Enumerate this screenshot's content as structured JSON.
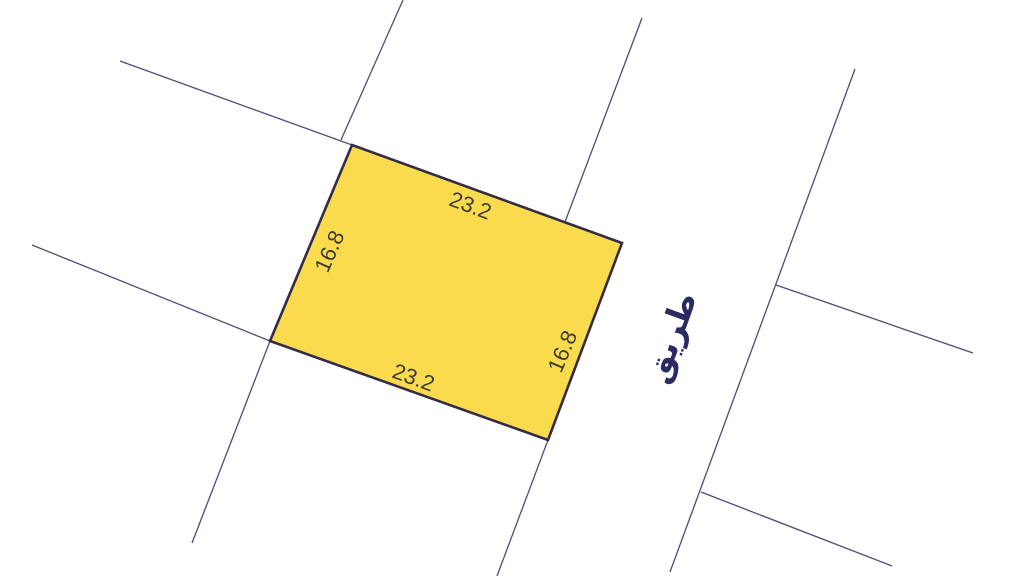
{
  "map": {
    "parcel": {
      "dimension_labels": {
        "top": "23.2",
        "left": "16.8",
        "bottom": "23.2",
        "right": "16.8"
      }
    },
    "road_label": "طريق"
  },
  "colors": {
    "background": "#FFFFFF",
    "parcel-fill": "#F9DB4D",
    "parcel-stroke": "#342B49",
    "boundary-line": "#4C4C7C",
    "dimension-text": "#3D3A3A",
    "road-text": "#2B2A63"
  }
}
